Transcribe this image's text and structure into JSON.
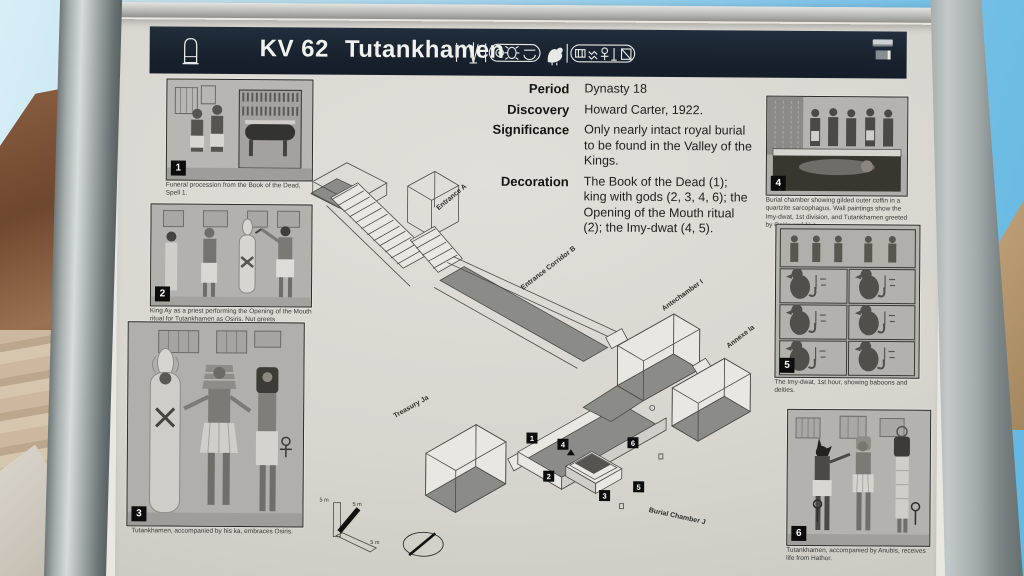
{
  "sign": {
    "header": {
      "catalog": "KV 62",
      "name": "Tutankhamen",
      "icons": {
        "stela": "stela-outline-icon",
        "cartouches": "royal-cartouche-hieroglyphs",
        "logos": "sponsor-logos"
      },
      "colors": {
        "bar_bg": "#18222e",
        "text": "#f1f1ee"
      }
    },
    "facts": [
      {
        "label": "Period",
        "value": "Dynasty 18"
      },
      {
        "label": "Discovery",
        "value": "Howard Carter, 1922."
      },
      {
        "label": "Significance",
        "value": "Only nearly intact royal burial to be found in the Valley of the Kings."
      },
      {
        "label": "Decoration",
        "value": "The Book of the Dead (1); king with gods (2, 3, 4, 6); the Opening of the Mouth ritual (2); the Imy-dwat (4, 5)."
      }
    ],
    "photos_left": [
      {
        "number": "1",
        "caption": "Funeral procession from the Book of the Dead, Spell 1."
      },
      {
        "number": "2",
        "caption": "King Ay as a priest performing the Opening of the Mouth ritual for Tutankhamen as Osiris. Nut greets Tutankhamen at the left."
      },
      {
        "number": "3",
        "caption": "Tutankhamen, accompanied by his ka, embraces Osiris."
      }
    ],
    "photos_right": [
      {
        "number": "4",
        "caption": "Burial chamber showing gilded outer coffin in a quartzite sarcophagus. Wall paintings show the Imy-dwat, 1st division, and Tutankhamen greeted by Osiris and Nut."
      },
      {
        "number": "5",
        "caption": "The Imy-dwat, 1st hour, showing baboons and deities."
      },
      {
        "number": "6",
        "caption": "Tutankhamen, accompanied by Anubis, receives life from Hathor."
      }
    ],
    "diagram": {
      "labels": {
        "entrance_a": "Entrance A",
        "corridor_b": "Entrance Corridor B",
        "antechamber": "Antechamber I",
        "annexe": "Annexe Ia",
        "treasury": "Treasury Ja",
        "burial_chamber": "Burial Chamber J"
      },
      "markers": [
        "1",
        "2",
        "3",
        "4",
        "5",
        "6"
      ],
      "scale_label": "5 m",
      "icons": {
        "compass": "north-arrow-ellipse-icon",
        "scale": "isometric-scale-bars-icon"
      }
    },
    "colors": {
      "panel_bg": "#d7d5ce",
      "badge_bg": "#0c0c0c",
      "sky": "#7fc4e8",
      "pole": "#a6aeae"
    }
  }
}
